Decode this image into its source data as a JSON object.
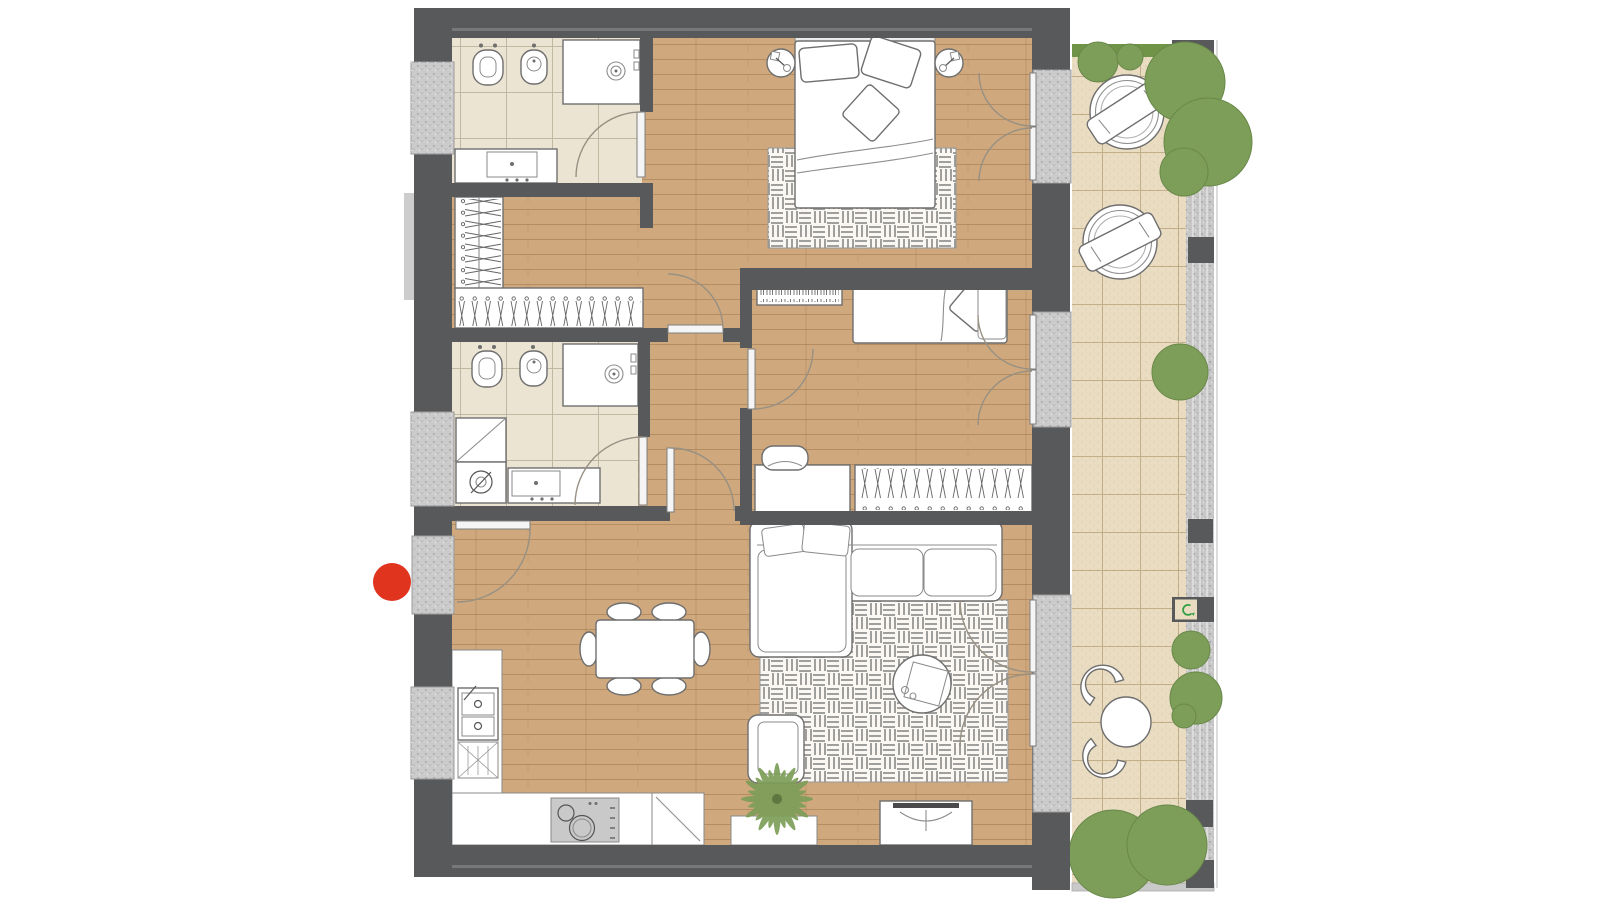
{
  "scene": {
    "type": "apartment-floor-plan-top-view",
    "background": "#ffffff",
    "marker_meaning": "entrance-dot"
  },
  "colors": {
    "wall": "#58595b",
    "wall_inner_line": "#828282",
    "wood": "#cfa87d",
    "bath_tile": "#ece4d3",
    "terrace_tile": "#e9dcc1",
    "gravel": "#c7c7c7",
    "granite": "#cbcbcb",
    "green": "#7d9e58",
    "hedge": "#6f9447",
    "marker": "#e0341f",
    "cooktop": "#c9c9c9",
    "tv": "#4a4a4a",
    "drain_green": "#2f9e44",
    "furniture_stroke": "#6e6e6e",
    "rug_line": "#8f8f8f"
  },
  "rooms": [
    {
      "id": "bathroom-1",
      "furniture": [
        "wall-hung-toilet",
        "bidet",
        "shower-tray",
        "vanity-sink"
      ]
    },
    {
      "id": "walk-in-closet",
      "furniture": [
        "wardrobe-left-hangers",
        "wardrobe-bottom-hangers"
      ]
    },
    {
      "id": "master-bedroom",
      "furniture": [
        "double-bed",
        "nightstand-left",
        "nightstand-right",
        "basket-weave-rug",
        "french-door-to-terrace"
      ]
    },
    {
      "id": "bedroom-2",
      "furniture": [
        "single-bed",
        "bookshelf",
        "desk",
        "desk-chair",
        "wardrobe-hangers",
        "french-door-to-terrace"
      ]
    },
    {
      "id": "bathroom-2",
      "furniture": [
        "wall-hung-toilet",
        "bidet",
        "shower-tray",
        "tall-cabinet",
        "washing-machine",
        "vanity-sink"
      ]
    },
    {
      "id": "hallway",
      "furniture": []
    },
    {
      "id": "living-kitchen",
      "furniture": [
        "entry-door",
        "kitchen-counter-left",
        "double-sink",
        "dish-rack",
        "kitchen-counter-bottom",
        "cooktop",
        "corner-cabinet",
        "dining-table",
        "dining-chairs-x6",
        "sectional-sofa",
        "basket-weave-rug",
        "round-coffee-table",
        "armchair",
        "tv-bench",
        "plant-bench",
        "palm-plant",
        "french-door-to-terrace"
      ]
    },
    {
      "id": "terrace",
      "furniture": [
        "hedge-top",
        "round-lounger-1",
        "round-lounger-2",
        "bistro-table",
        "bistro-chair-1",
        "bistro-chair-2",
        "gravel-strip",
        "dark-planters",
        "bushes",
        "drain-box"
      ]
    }
  ],
  "marker": {
    "id": "entrance-marker",
    "shape": "red-dot",
    "x": 392,
    "y": 582,
    "r": 19
  }
}
